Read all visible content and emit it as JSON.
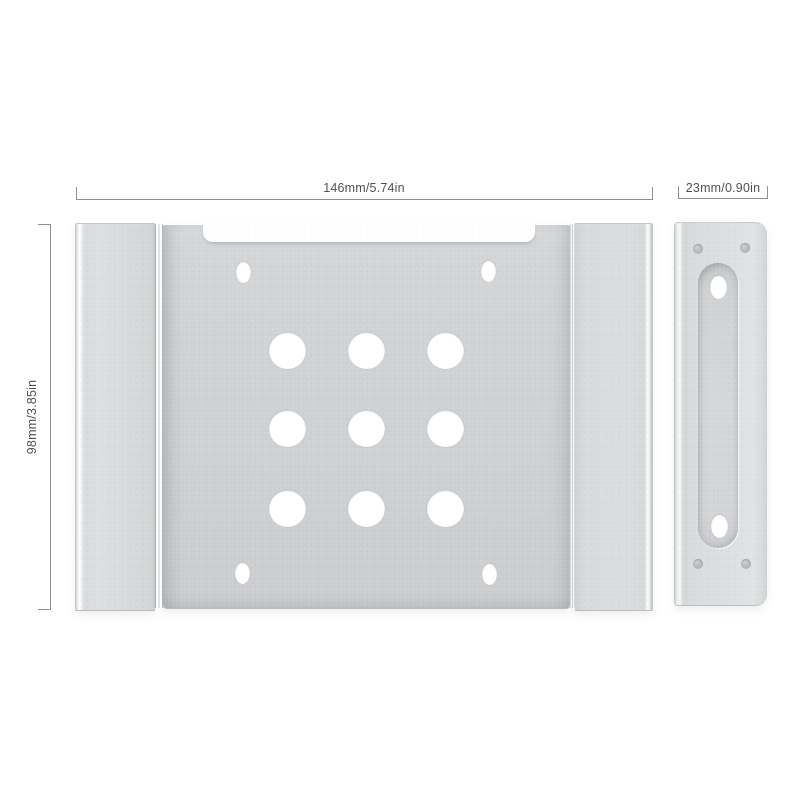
{
  "dimensions": {
    "width_label": "146mm/5.74in",
    "height_label": "98mm/3.85in",
    "side_width_label": "23mm/0.90in"
  },
  "colors": {
    "background": "#ffffff",
    "metal_base": "#d0d2d4",
    "metal_light": "#dcdee0",
    "metal_edge": "#b9bbbd",
    "dimension_line": "#8d8f91",
    "dimension_text": "#4e5052",
    "hole": "#ffffff",
    "rivet": "#b0b2b4"
  },
  "figure": {
    "main_bracket": {
      "circle_holes": [
        [
          212,
          127
        ],
        [
          291,
          127
        ],
        [
          370,
          127
        ],
        [
          212,
          205
        ],
        [
          291,
          205
        ],
        [
          370,
          205
        ],
        [
          212,
          285
        ],
        [
          291,
          285
        ],
        [
          370,
          285
        ]
      ],
      "circle_diameter": 37,
      "slot_holes": [
        [
          168,
          49
        ],
        [
          413,
          48
        ],
        [
          167,
          350
        ],
        [
          414,
          351
        ]
      ],
      "slot_size": [
        15,
        22
      ]
    },
    "side_bracket": {
      "slot_holes": [
        [
          44,
          64
        ],
        [
          45,
          303
        ]
      ],
      "slot_size": [
        17,
        24
      ],
      "rivets": [
        [
          24,
          26
        ],
        [
          71,
          25
        ],
        [
          24,
          341
        ],
        [
          72,
          341
        ]
      ],
      "rivet_diameter": 10
    }
  }
}
